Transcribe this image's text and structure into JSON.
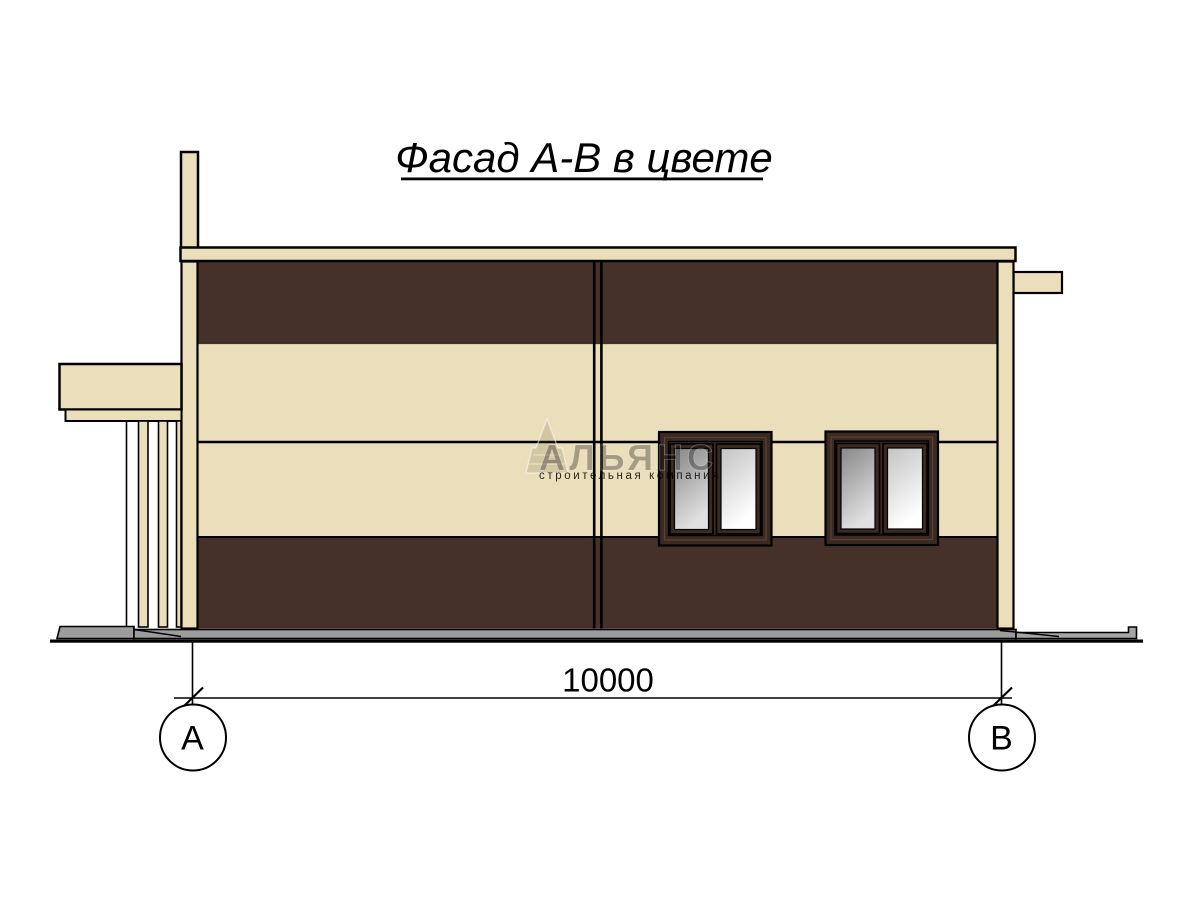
{
  "drawing": {
    "title": "Фасад А-В в цвете",
    "dimension_total": "10000",
    "axis_left": "А",
    "axis_right": "В"
  },
  "watermark": {
    "name": "АЛЬЯНС",
    "tagline": "строительная компания"
  },
  "colors": {
    "background": "#ffffff",
    "panel_cream": "#ebdfbb",
    "panel_brown": "#45302a",
    "window_frame": "#3a2a22",
    "window_frame_bevel": "#6a4f3f",
    "glass_dark_top": "#878787",
    "glass_dark_bottom": "#e0e0e0",
    "glass_light_top": "#c3c3c3",
    "glass_light_bottom": "#ffffff",
    "foundation_gray": "#9c9c9c",
    "foundation_gray_light": "#a6a6a6",
    "line_black": "#000000",
    "watermark_brown": "#6a5638",
    "watermark_white": "#ffffff"
  }
}
